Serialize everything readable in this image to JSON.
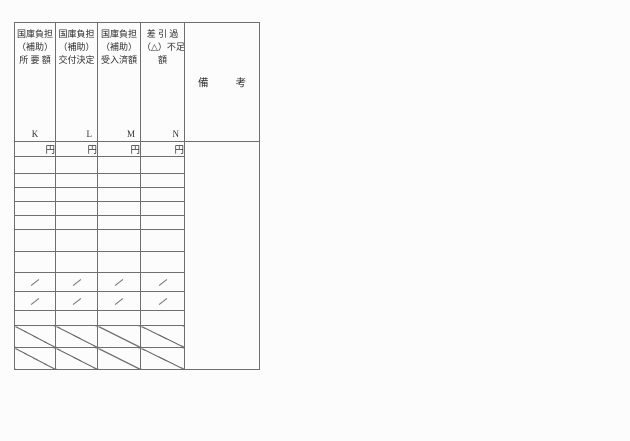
{
  "page": {
    "background": "#fcfcfc",
    "line_color": "#6f6f6f",
    "text_color": "#2e2e2e"
  },
  "table": {
    "columns": [
      {
        "header_lines": [
          "国庫負担",
          "（補助）",
          "所 要 額"
        ],
        "letter": "K",
        "unit": "円"
      },
      {
        "header_lines": [
          "国庫負担",
          "（補助）",
          "交付決定"
        ],
        "letter": "L",
        "unit": "円"
      },
      {
        "header_lines": [
          "国庫負担",
          "（補助）",
          "受入済額"
        ],
        "letter": "M",
        "unit": "円"
      },
      {
        "header_lines": [
          "差 引 過",
          "（△）不足",
          "額"
        ],
        "letter": "N",
        "unit": "円"
      }
    ],
    "remarks": {
      "left_char": "備",
      "right_char": "考"
    },
    "structure": {
      "empty_amount_rows": 7,
      "slash_mark_rows": 2,
      "empty_rows_below_slashes": 1,
      "crossed_out_rows": 2
    }
  }
}
